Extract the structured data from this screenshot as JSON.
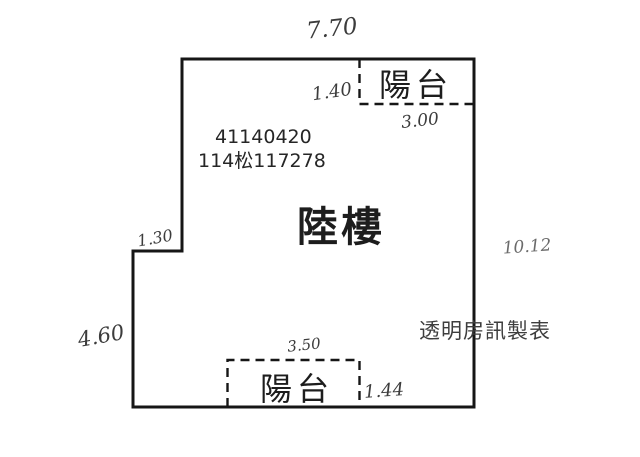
{
  "plan": {
    "floor_title": "陸樓",
    "registry_line1": "41140420",
    "registry_line2": "114松117278",
    "watermark": "透明房訊製表",
    "balcony_top_label": "陽台",
    "balcony_bottom_label": "陽台",
    "dims": {
      "top_width": "7.70",
      "balcony_top_depth": "1.40",
      "balcony_top_width": "3.00",
      "left_notch": "1.30",
      "right_height": "10.12",
      "left_lower_height": "4.60",
      "balcony_bottom_width": "3.50",
      "balcony_bottom_depth": "1.44"
    },
    "colors": {
      "outline": "#161616",
      "handwriting": "#3c3c3c",
      "handwriting_light": "#6b6b6b",
      "print_text": "#262626",
      "watermark_text": "#3d3d3d"
    }
  }
}
